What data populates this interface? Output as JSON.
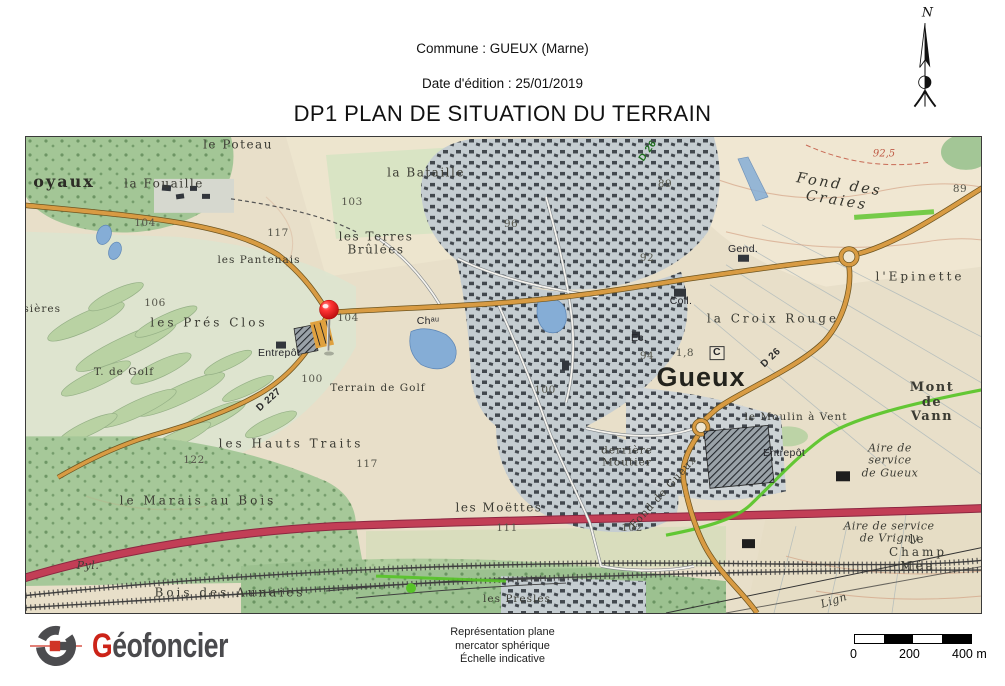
{
  "header": {
    "commune": "Commune : GUEUX (Marne)",
    "edition_date": "Date d'édition : 25/01/2019",
    "title": "DP1 PLAN DE SITUATION DU TERRAIN"
  },
  "north_arrow": {
    "label": "N"
  },
  "map": {
    "labels": [
      {
        "text": "oyaux",
        "x": 38,
        "y": 45,
        "cls": "ld ld-lg"
      },
      {
        "text": "la Fouaille",
        "x": 138,
        "y": 47,
        "cls": "ld"
      },
      {
        "text": "le Poteau",
        "x": 212,
        "y": 8,
        "cls": "ld"
      },
      {
        "text": "la Bataille",
        "x": 400,
        "y": 36,
        "cls": "ld"
      },
      {
        "text": "les Terres\nBrûlées",
        "x": 350,
        "y": 107,
        "cls": "ld"
      },
      {
        "text": "les Pantenais",
        "x": 233,
        "y": 124,
        "cls": "ld ld-sm"
      },
      {
        "text": "104",
        "x": 119,
        "y": 87,
        "cls": "num"
      },
      {
        "text": "117",
        "x": 252,
        "y": 97,
        "cls": "num"
      },
      {
        "text": "104",
        "x": 322,
        "y": 182,
        "cls": "num"
      },
      {
        "text": "103",
        "x": 326,
        "y": 66,
        "cls": "num"
      },
      {
        "text": "96",
        "x": 485,
        "y": 88,
        "cls": "num"
      },
      {
        "text": "106",
        "x": 129,
        "y": 167,
        "cls": "num"
      },
      {
        "text": "isières",
        "x": 14,
        "y": 173,
        "cls": "ld ld-sm"
      },
      {
        "text": "les Prés Clos",
        "x": 183,
        "y": 186,
        "cls": "ld wide"
      },
      {
        "text": "Entrepôt",
        "x": 253,
        "y": 217,
        "cls": "inf"
      },
      {
        "text": "T. de Golf",
        "x": 98,
        "y": 236,
        "cls": "ld ld-sm"
      },
      {
        "text": "Terrain de Golf",
        "x": 352,
        "y": 252,
        "cls": "ld ld-sm"
      },
      {
        "text": "D 227",
        "x": 243,
        "y": 263,
        "cls": "road",
        "rot": -42
      },
      {
        "text": "les Hauts Traits",
        "x": 265,
        "y": 307,
        "cls": "ld wide"
      },
      {
        "text": "122",
        "x": 168,
        "y": 324,
        "cls": "num"
      },
      {
        "text": "117",
        "x": 341,
        "y": 328,
        "cls": "num"
      },
      {
        "text": "100",
        "x": 286,
        "y": 243,
        "cls": "num"
      },
      {
        "text": "le Marais au Bois",
        "x": 172,
        "y": 364,
        "cls": "ld wide"
      },
      {
        "text": "Bois des Aunaies",
        "x": 204,
        "y": 456,
        "cls": "ld wide"
      },
      {
        "text": "Pyl.",
        "x": 62,
        "y": 429,
        "cls": "ital"
      },
      {
        "text": "les Moëttes",
        "x": 473,
        "y": 371,
        "cls": "ld"
      },
      {
        "text": "111",
        "x": 481,
        "y": 392,
        "cls": "num"
      },
      {
        "text": "102",
        "x": 606,
        "y": 392,
        "cls": "num"
      },
      {
        "text": "les Presles",
        "x": 491,
        "y": 463,
        "cls": "ld ld-sm"
      },
      {
        "text": "Fond de Gueux",
        "x": 638,
        "y": 356,
        "cls": "ld ld-sm",
        "rot": -48
      },
      {
        "text": "derrière\nMoutier",
        "x": 601,
        "y": 320,
        "cls": "ld ld-sm"
      },
      {
        "text": "le Moulin à Vent",
        "x": 770,
        "y": 281,
        "cls": "ld ld-sm"
      },
      {
        "text": "Mont de Vann",
        "x": 906,
        "y": 266,
        "cls": "md"
      },
      {
        "text": "Entrepôt",
        "x": 758,
        "y": 317,
        "cls": "inf"
      },
      {
        "text": "Aire de service\nde Gueux",
        "x": 864,
        "y": 324,
        "cls": "ital"
      },
      {
        "text": "Aire de service de Vrigny",
        "x": 863,
        "y": 396,
        "cls": "ital"
      },
      {
        "text": "le Champ Méa",
        "x": 892,
        "y": 416,
        "cls": "ld wide"
      },
      {
        "text": "Lign",
        "x": 808,
        "y": 464,
        "cls": "ital",
        "rot": -18
      },
      {
        "text": "Fond des Craies",
        "x": 812,
        "y": 56,
        "cls": "ital ital-lg",
        "rot": 9
      },
      {
        "text": "Gend.",
        "x": 717,
        "y": 113,
        "cls": "inf"
      },
      {
        "text": "l'Epinette",
        "x": 894,
        "y": 140,
        "cls": "ld wide"
      },
      {
        "text": "89",
        "x": 934,
        "y": 53,
        "cls": "num"
      },
      {
        "text": "89",
        "x": 639,
        "y": 48,
        "cls": "num"
      },
      {
        "text": "92",
        "x": 621,
        "y": 122,
        "cls": "num"
      },
      {
        "text": "92,5",
        "x": 858,
        "y": 17,
        "cls": "contour"
      },
      {
        "text": "Coll.",
        "x": 655,
        "y": 165,
        "cls": "inf"
      },
      {
        "text": "la Croix Rouge",
        "x": 747,
        "y": 182,
        "cls": "ld wide"
      },
      {
        "text": "1,8",
        "x": 659,
        "y": 217,
        "cls": "num"
      },
      {
        "text": "C",
        "x": 691,
        "y": 216,
        "cls": "inf boxed"
      },
      {
        "text": "94",
        "x": 621,
        "y": 220,
        "cls": "num"
      },
      {
        "text": "Gueux",
        "x": 675,
        "y": 240,
        "cls": "town"
      },
      {
        "text": "D 26",
        "x": 745,
        "y": 221,
        "cls": "road",
        "rot": -44
      },
      {
        "text": "D 26",
        "x": 622,
        "y": 14,
        "cls": "road road-gr",
        "rot": -55
      },
      {
        "text": "Chᵃᵘ",
        "x": 402,
        "y": 185,
        "cls": "inf"
      },
      {
        "text": "Ec.",
        "x": 613,
        "y": 202,
        "cls": "inf"
      },
      {
        "text": "100",
        "x": 519,
        "y": 254,
        "cls": "num"
      }
    ]
  },
  "footer": {
    "logo_g": "G",
    "logo_rest": "éofoncier",
    "projection_lines": [
      "Représentation plane",
      "mercator sphérique",
      "Échelle indicative"
    ],
    "scale_bar": {
      "ticks": [
        "0",
        "200",
        "400 m"
      ]
    }
  },
  "colors": {
    "pin_red": "#e02020",
    "road_orange": "#d89b43",
    "highway_red": "#c23e56",
    "trail_green": "#57c427",
    "logo_red": "#cc2318"
  }
}
